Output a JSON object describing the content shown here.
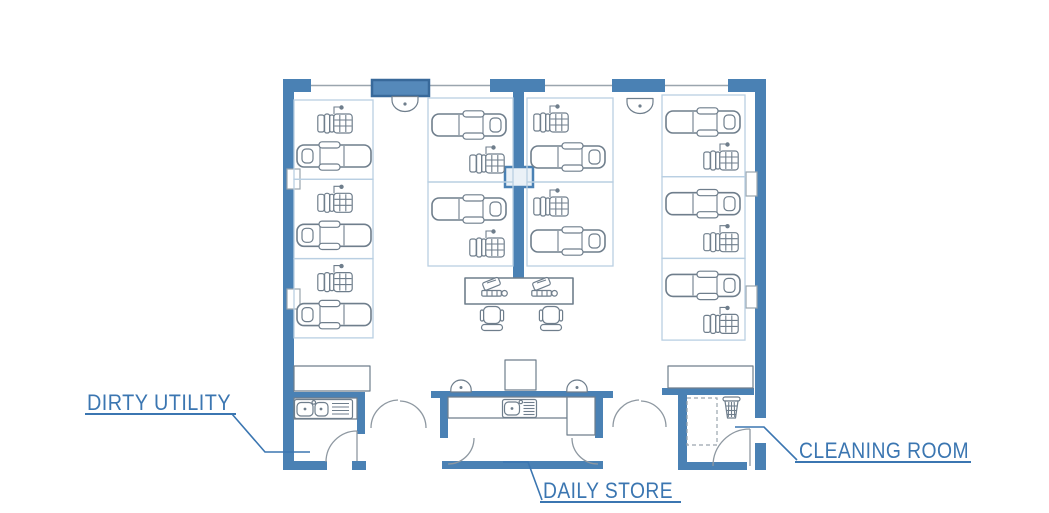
{
  "diagram": {
    "subject": "dental clinic floor plan"
  },
  "colors": {
    "wall": "#4a81b4",
    "bay_border": "#b9cfe2",
    "furniture": "#6f7e8c",
    "thin": "#9aa5ae",
    "door": "#8e98a1",
    "label": "#3b76b1",
    "panel_fill": "#5589ba",
    "panel_stroke": "#38699a",
    "background": "#ffffff"
  },
  "labels": {
    "dirty_utility": "DIRTY UTILITY",
    "daily_store": "DAILY STORE",
    "cleaning_room": "CLEANING ROOM"
  },
  "bays": {
    "columns": [
      {
        "name": "left-bay-column",
        "x": 294,
        "y": 100,
        "width": 79,
        "count": 3,
        "bay_height": 79.3,
        "variant": "cart-then-chair-headrest-left"
      },
      {
        "name": "center-left-bay-column",
        "x": 428,
        "y": 98,
        "width": 85,
        "count": 2,
        "bay_height": 84,
        "variant": "chair-headrest-right-then-cart"
      },
      {
        "name": "center-right-bay-column",
        "x": 527,
        "y": 98,
        "width": 86,
        "count": 2,
        "bay_height": 84,
        "variant": "cart-then-chair-headrest-right"
      },
      {
        "name": "right-bay-column",
        "x": 662,
        "y": 95,
        "width": 83,
        "count": 3,
        "bay_height": 81.7,
        "variant": "chair-headrest-right-then-cart"
      }
    ]
  },
  "equipment_counts": {
    "dental_chairs": 10,
    "delivery_carts": 10,
    "reception_workstations": 2,
    "office_chairs": 2,
    "sinks": 2,
    "waste_bins": 1
  }
}
